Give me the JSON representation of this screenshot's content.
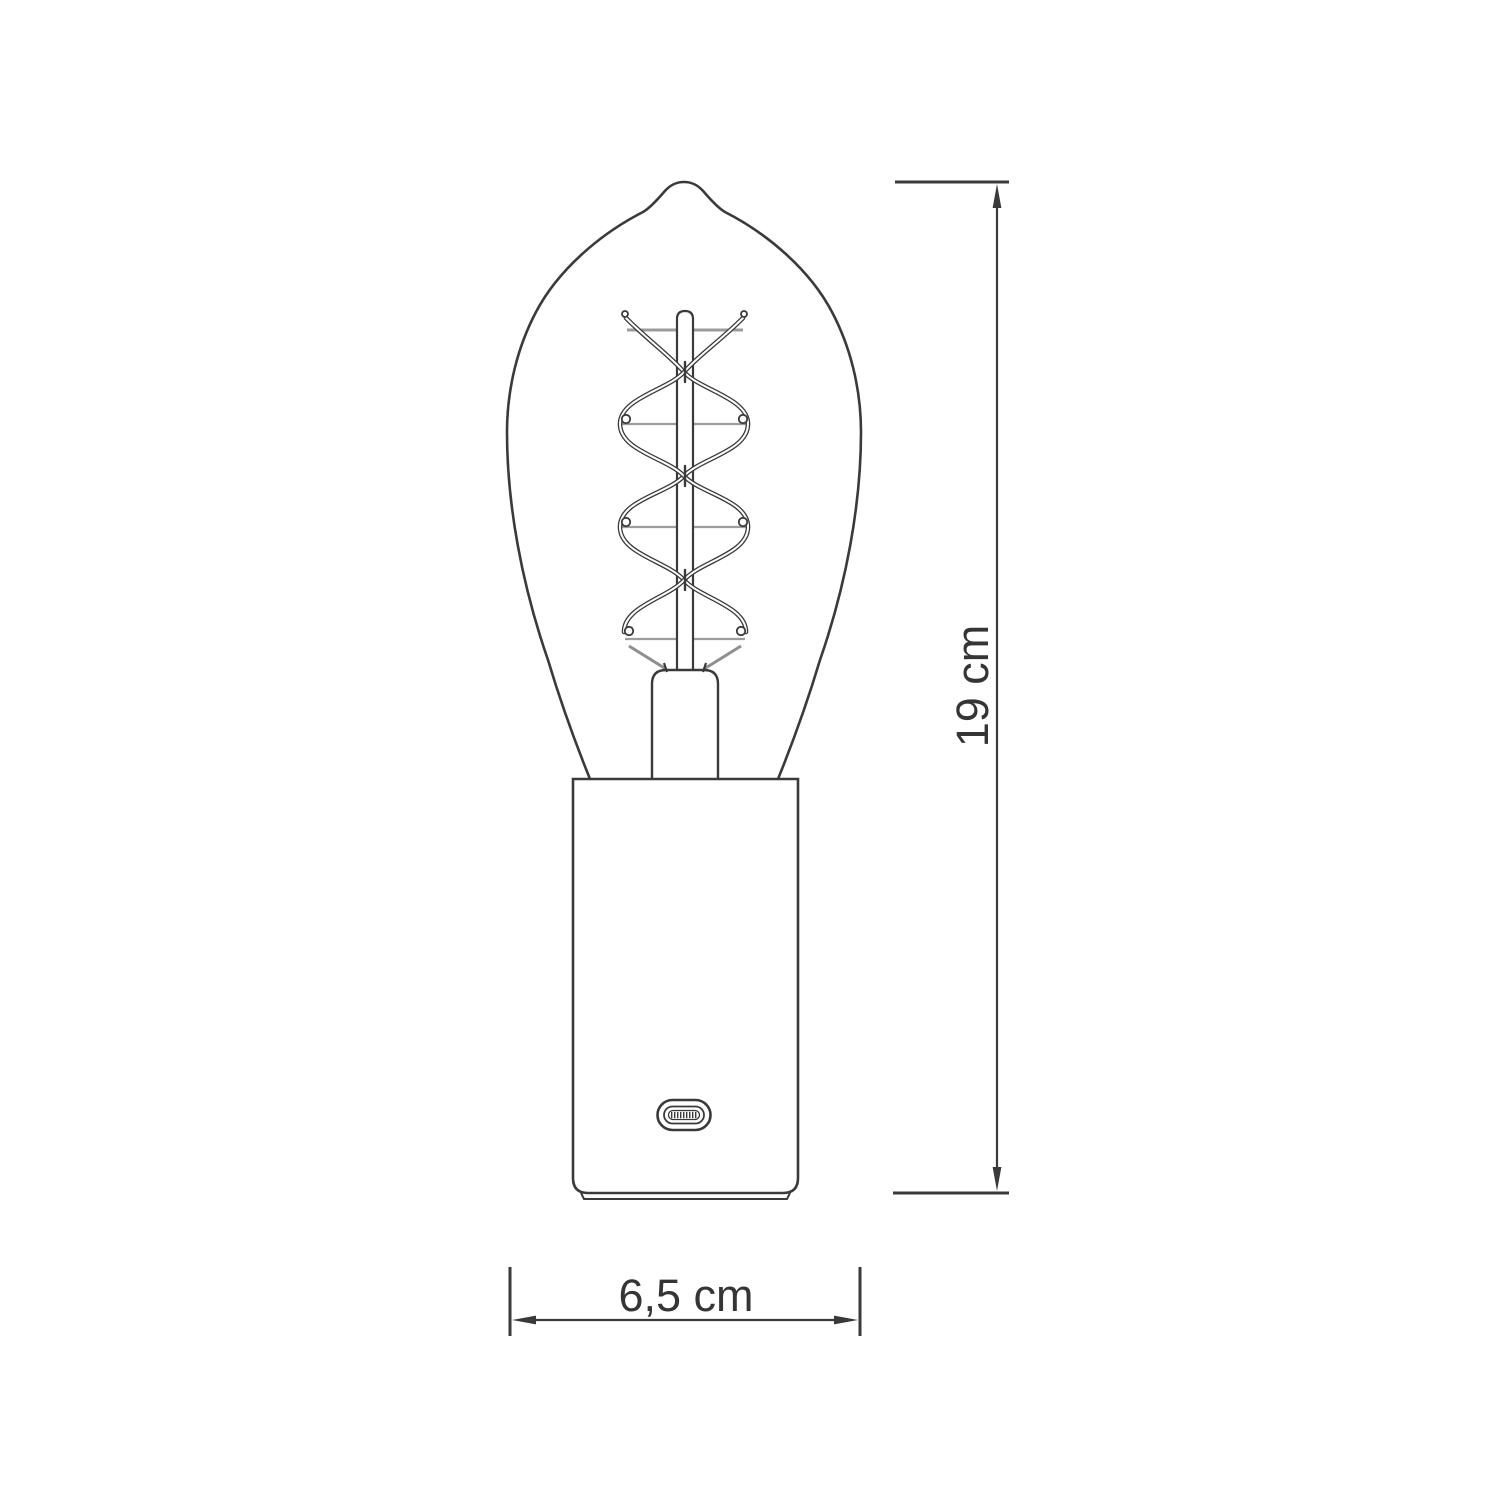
{
  "colors": {
    "bg": "#ffffff",
    "line": "#3a3a38",
    "support": "#9c9c9c",
    "diagonal": "#8f8f8f",
    "text": "#353533"
  },
  "diagram": {
    "dimensions": {
      "height": {
        "label": "19 cm"
      },
      "width": {
        "label": "6,5 cm"
      }
    }
  }
}
